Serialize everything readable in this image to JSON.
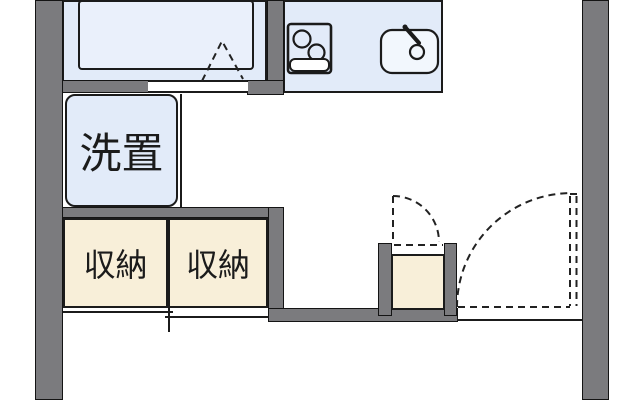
{
  "floorplan": {
    "labels": {
      "washer_space": "洗置",
      "storage_left": "収納",
      "storage_right": "収納"
    },
    "colors": {
      "wall-gray": "#7b7b7e",
      "room-blue": "#e2ebf9",
      "tub-blue": "#eaf0fb",
      "storage-cream": "#f8efd9",
      "line-dark": "#1b1b1b",
      "background": "#ffffff"
    }
  }
}
